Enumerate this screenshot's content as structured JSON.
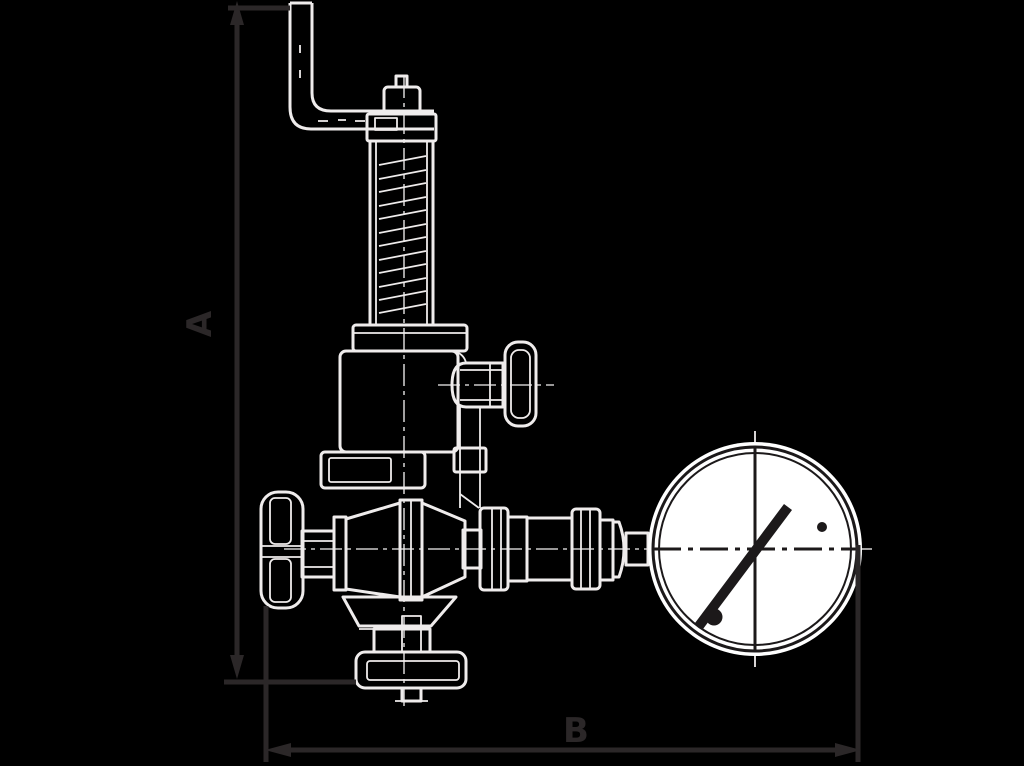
{
  "figure": {
    "type": "technical-dimension-drawing",
    "description_parts": [
      "test-lever",
      "spring-bonnet",
      "gauge-cock-handwheel",
      "inlet-handwheel",
      "valve-body",
      "union-nut",
      "pressure-gauge"
    ]
  },
  "labels": {
    "height_label": "A",
    "width_label": "B"
  },
  "colors": {
    "background": "#000000",
    "drawing_line": "#efecec",
    "dimension_line": "#2b2728",
    "gauge_face": "#ffffff",
    "gauge_detail": "#1c191a"
  }
}
